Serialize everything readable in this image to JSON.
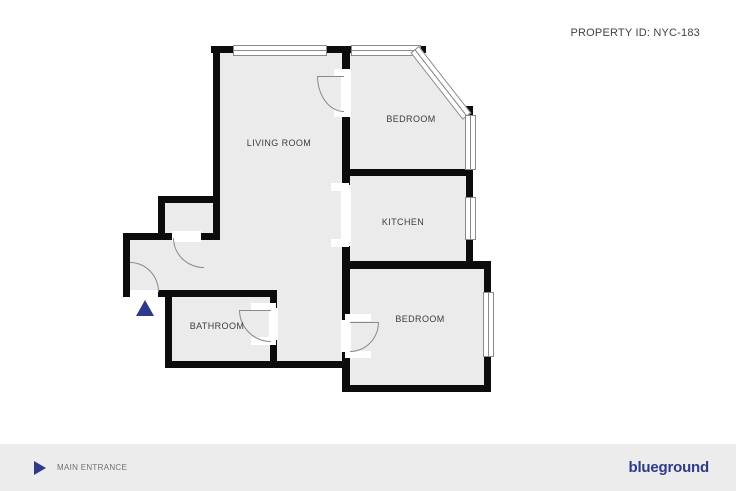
{
  "header": {
    "property_id": "PROPERTY ID: NYC-183"
  },
  "plan": {
    "rooms": [
      {
        "id": "living-room",
        "label": "LIVING ROOM"
      },
      {
        "id": "bedroom-top",
        "label": "BEDROOM"
      },
      {
        "id": "kitchen",
        "label": "KITCHEN"
      },
      {
        "id": "bedroom-bottom",
        "label": "BEDROOM"
      },
      {
        "id": "bathroom",
        "label": "BATHROOM"
      }
    ],
    "entrance_marker_icon": "triangle-up-icon"
  },
  "footer": {
    "entrance_icon": "triangle-right-icon",
    "entrance_label": "MAIN ENTRANCE",
    "brand": "blueground"
  },
  "colors": {
    "accent_navy": "#2e3a8c",
    "wall_black": "#0c0c0c",
    "room_fill_gray": "#ebebeb",
    "line_gray": "#8a8a8a",
    "footer_bg": "#ececec"
  }
}
